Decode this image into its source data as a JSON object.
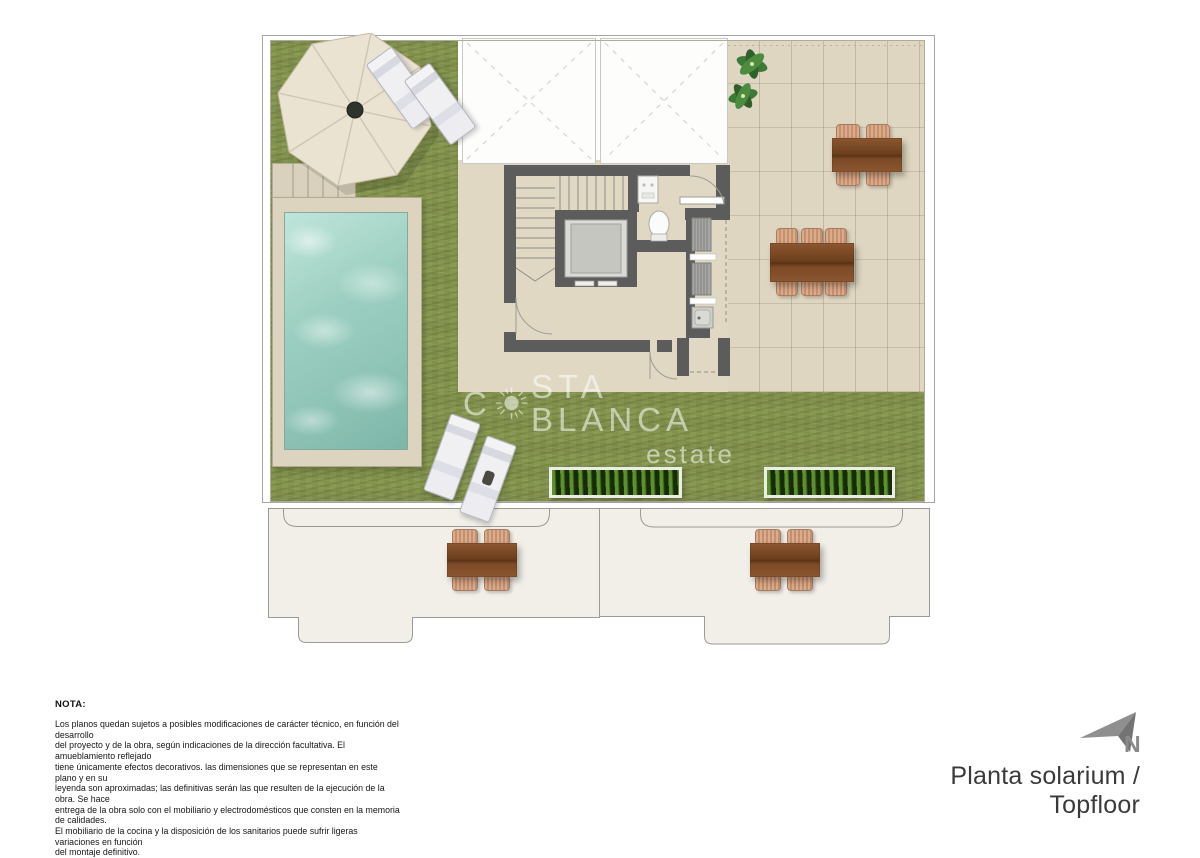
{
  "colors": {
    "grass": "#8b9a54",
    "pool_water": "#9ed0c3",
    "pool_deck": "#dcd4bf",
    "floor": "#e0d8c3",
    "terrace": "#ded6c1",
    "wall_gray": "#5c5c5c",
    "wood_brown": "#7c4a26",
    "chair_tan": "#d3a183",
    "planter": "#203a0e",
    "canopy": "#ebe3d2",
    "leaf_green": "#3d7a36",
    "watermark_white": "#ffffff",
    "title_gray": "#3a3a3a",
    "arrow_gray": "#8a8a8a"
  },
  "watermark": {
    "part1": "C",
    "part2": "STA BLANCA",
    "subtitle": "estate"
  },
  "icons": {
    "sun-icon": "circle-with-rays",
    "umbrella-icon": "octagon-parasol",
    "sun-lounger-icon": "rounded-rectangle",
    "pool-icon": "water-rectangle",
    "staircase-icon": "tread-lines",
    "elevator-icon": "nested-squares",
    "toilet-icon": "oval-wc",
    "plant-icon": "leaf-cluster",
    "dining-table-icon": "wood-table-with-chairs",
    "planter-icon": "green-hedge-box",
    "skylight-icon": "dashed-x-panel",
    "north-arrow-icon": "gray-dart"
  },
  "notes": {
    "heading": "NOTA:",
    "body": "Los planos quedan sujetos a posibles modificaciones de carácter técnico, en función del desarrollo\ndel proyecto y de la obra, según indicaciones de la dirección facultativa. El amueblamiento reflejado\ntiene únicamente efectos decorativos. las dimensiones que se representan en este plano y en su\nleyenda son aproximadas; las definitivas serán las que resulten de la ejecución de la obra. Se hace\nentrega de la obra solo con el mobiliario y electrodomésticos que consten en la memoria de calidades.\nEl mobiliario de la cocina y la disposición de los sanitarios puede sufrir ligeras variaciones en función\ndel montaje definitivo."
  },
  "footer": {
    "title": "Planta solarium / Topfloor",
    "north_label": "N"
  }
}
